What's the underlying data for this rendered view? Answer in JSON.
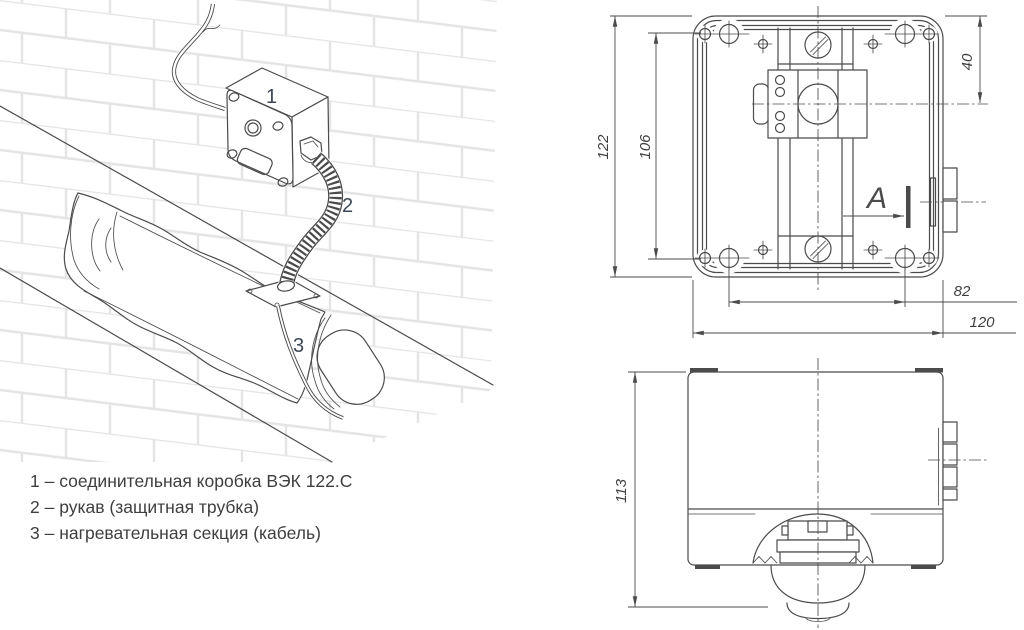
{
  "illustration": {
    "callouts": [
      {
        "id": "box",
        "label": "1"
      },
      {
        "id": "sleeve",
        "label": "2"
      },
      {
        "id": "cable",
        "label": "3"
      }
    ]
  },
  "legend": {
    "items": [
      "1 – соединительная коробка ВЭК 122.С",
      "2 – рукав (защитная трубка)",
      "3 – нагревательная секция (кабель)"
    ]
  },
  "front_view": {
    "view_label": "A",
    "dims": {
      "height": "122",
      "screw_span_v": "106",
      "gland_offset": "40",
      "screw_span_h": "82",
      "width": "120"
    }
  },
  "side_view": {
    "dims": {
      "height": "113"
    }
  },
  "colors": {
    "line": "#4b4b4b",
    "brick_line": "#e4e4e4",
    "callout_text": "#3c4654",
    "legend_text": "#3f3f3f"
  }
}
